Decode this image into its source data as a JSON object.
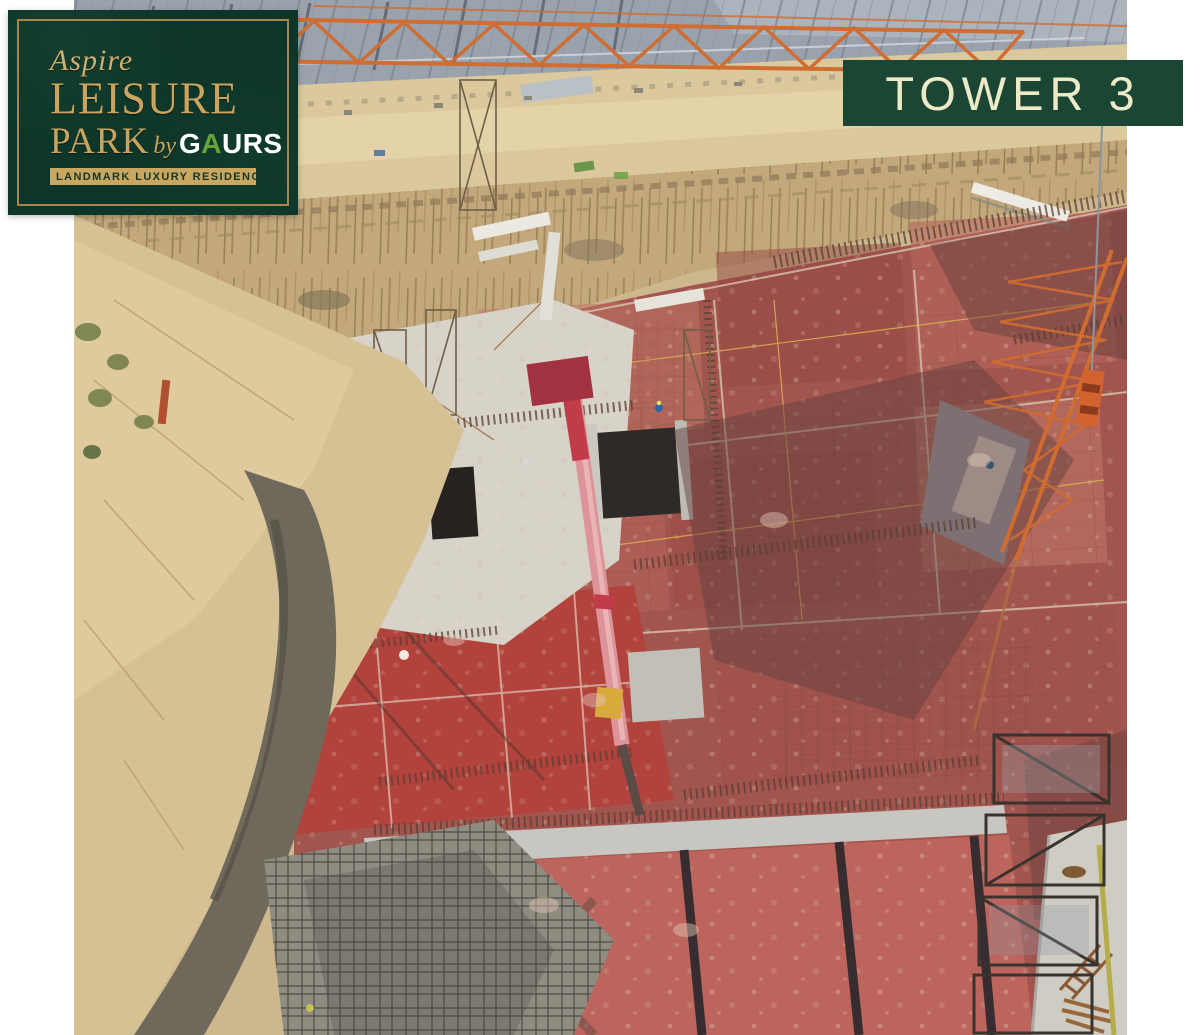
{
  "logo": {
    "aspire": "Aspire",
    "leisure": "LEISURE",
    "park": "PARK",
    "by": "by",
    "gaurs": {
      "g": "G",
      "a": "A",
      "urs": "URS"
    },
    "tagline": "LANDMARK LUXURY RESIDENCES"
  },
  "banner": {
    "label": "TOWER 3"
  },
  "photo": {
    "description": "Aerial drone view of a tower under construction: red shuttering-plywood formwork slabs with rebar mats and string lines, grey concrete walls and stair openings, excavation slope with sand road, corrugated shed roof crossed by an orange steel truss, orange tower-crane lattice and hook at right, pink concrete-pump boom in the centre, scaffolding and fresh concrete at lower left, ladder and timber planks at lower right"
  },
  "colors": {
    "brand_green": "#0d3529",
    "banner_green": "#1b4634",
    "gold_text": "#c9a45e",
    "gold_band": "#c9a760",
    "gold_border": "#a8854e",
    "cream_text": "#edeac8",
    "gaurs_a_green": "#67a43c",
    "formwork_red": "#a2554f",
    "sand": "#d6c195",
    "roof_grey": "#9aa3ad",
    "truss_orange": "#cf6d32"
  }
}
